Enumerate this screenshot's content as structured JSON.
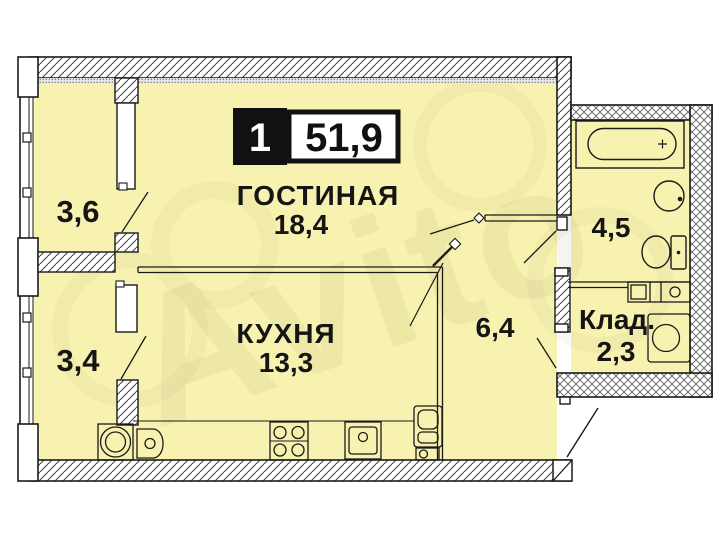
{
  "badge": {
    "rooms_count": "1",
    "total_area": "51,9"
  },
  "watermark_text": "Avito",
  "rooms": {
    "living": {
      "name": "ГОСТИНАЯ",
      "area": "18,4"
    },
    "kitchen": {
      "name": "КУХНЯ",
      "area": "13,3"
    },
    "balcony_top": {
      "area": "3,6"
    },
    "balcony_bottom": {
      "area": "3,4"
    },
    "bathroom": {
      "area": "4,5"
    },
    "hallway": {
      "area": "6,4"
    },
    "storage": {
      "name": "Клад.",
      "area": "2,3"
    }
  },
  "colors": {
    "room_fill": "#f7f2b0",
    "wall_outline": "#1a1a1a",
    "badge_black": "#111111",
    "badge_white": "#ffffff"
  },
  "fixtures": [
    "bathtub-icon",
    "wash-basin-icon",
    "toilet-icon",
    "storage-counter-icon",
    "washing-machine-storage-icon",
    "washing-machine-kitchen-icon",
    "small-appliance-icon",
    "stove-icon",
    "kitchen-sink-icon",
    "fridge-icon",
    "entrance-door-icon"
  ]
}
